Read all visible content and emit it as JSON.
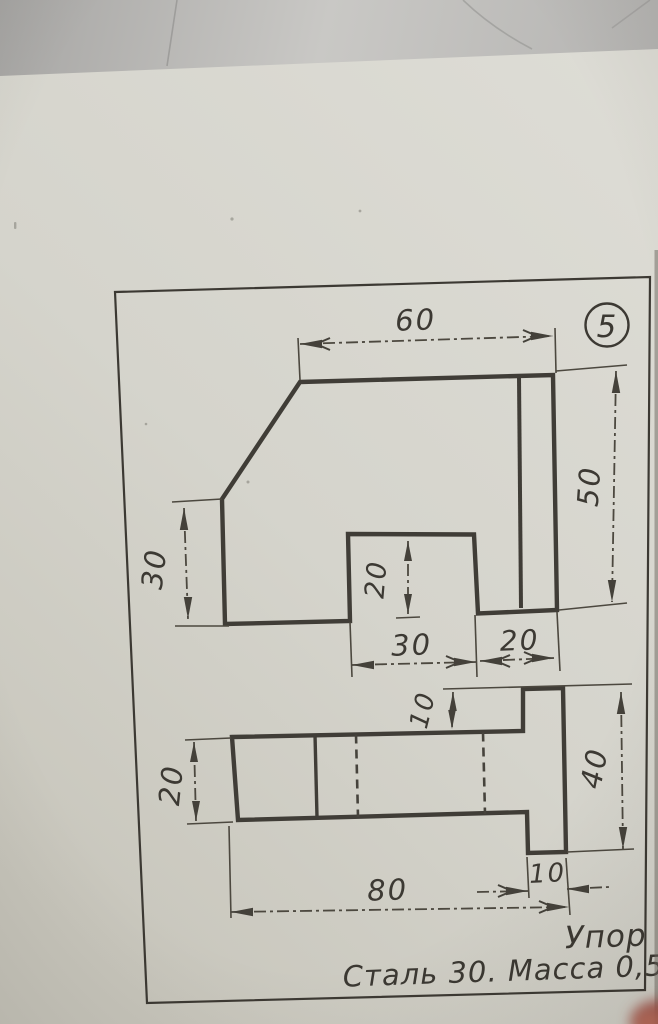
{
  "card": {
    "number": "5"
  },
  "title_block": {
    "part_name": "Упор",
    "material_mass": "Сталь 30. Масса 0,5"
  },
  "top_view": {
    "dim_top_width": "60",
    "dim_right_height": "50",
    "dim_left_height": "30",
    "dim_notch_depth": "20",
    "dim_notch_width": "30",
    "dim_right_segment": "20"
  },
  "front_view": {
    "dim_top_step": "10",
    "dim_overall_height": "40",
    "dim_left_height": "20",
    "dim_foot_width": "10",
    "dim_overall_length": "80"
  }
}
